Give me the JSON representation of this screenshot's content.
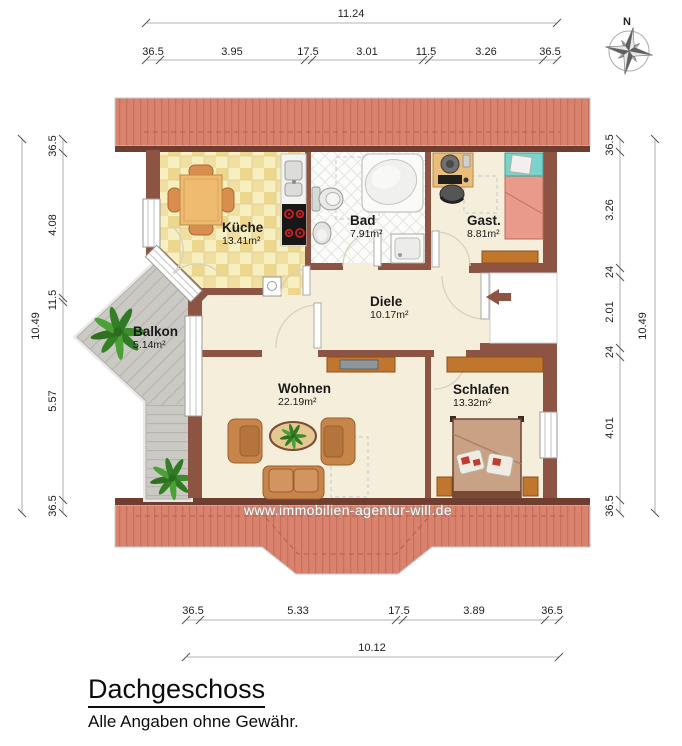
{
  "title": {
    "heading": "Dachgeschoss",
    "disclaimer": "Alle Angaben ohne Gewähr."
  },
  "watermark": "www.immobilien-agentur-will.de",
  "compass": {
    "north_label": "N"
  },
  "rooms": {
    "kueche": {
      "name": "Küche",
      "area": "13.41m²"
    },
    "bad": {
      "name": "Bad",
      "area": "7.91m²"
    },
    "gast": {
      "name": "Gast.",
      "area": "8.81m²"
    },
    "diele": {
      "name": "Diele",
      "area": "10.17m²"
    },
    "balkon": {
      "name": "Balkon",
      "area": "5.14m²"
    },
    "wohnen": {
      "name": "Wohnen",
      "area": "22.19m²"
    },
    "schlafen": {
      "name": "Schlafen",
      "area": "13.32m²"
    }
  },
  "dimensions": {
    "top": {
      "overall": "11.24",
      "segments": [
        "36.5",
        "3.95",
        "17.5",
        "3.01",
        "11.5",
        "3.26",
        "36.5"
      ]
    },
    "bottom": {
      "overall": "10.12",
      "segments": [
        "36.5",
        "5.33",
        "17.5",
        "3.89",
        "36.5"
      ]
    },
    "left": {
      "overall": "10.49",
      "segments": [
        "36.5",
        "4.08",
        "11.5",
        "5.57",
        "36.5"
      ]
    },
    "right": {
      "overall": "10.49",
      "segments": [
        "36.5",
        "3.26",
        "24",
        "2.01",
        "24",
        "4.01",
        "36.5"
      ]
    }
  },
  "colors": {
    "roof": "#d9836f",
    "walls": "#8d5443",
    "floor": "#f4eedb",
    "kitchen_tile": "#edd78c",
    "balcony_deck": "#cbc9c3",
    "furniture_wood": "#c1762e",
    "bed_pink": "#e89a8b",
    "accent_teal": "#79d2cc"
  }
}
